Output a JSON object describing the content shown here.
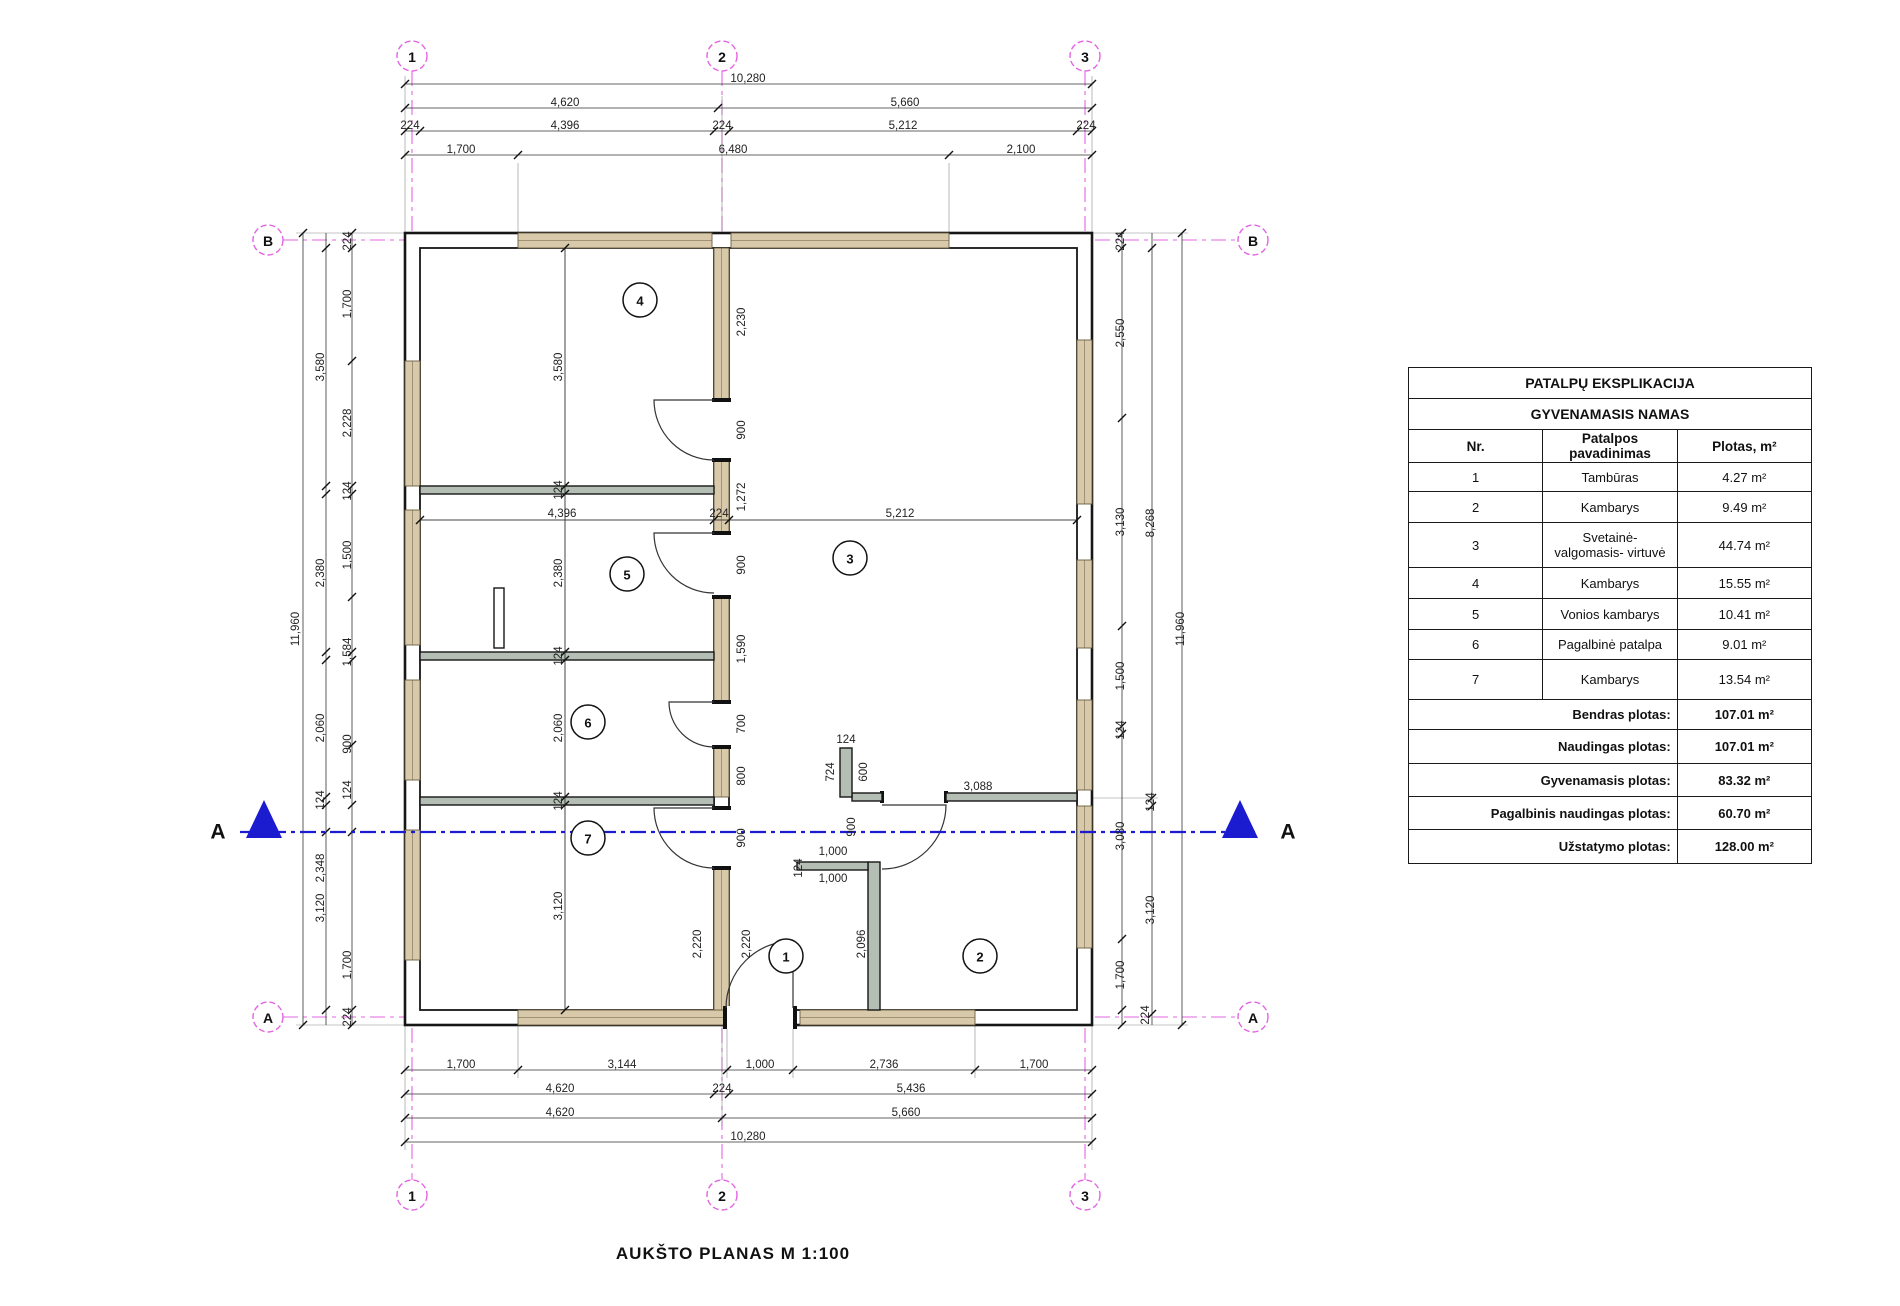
{
  "title": "AUKŠTO PLANAS  M 1:100",
  "colors": {
    "wall_window_fill": "#d8c9aa",
    "window_edge": "#6b5d40",
    "partition_fill": "#b5beb5",
    "grid_line": "#e364e3",
    "section_line": "#1b1bd0",
    "wall_line": "#161616",
    "dim_text": "#222222"
  },
  "section": {
    "label": "A"
  },
  "grid_circles": [
    {
      "label": "1",
      "x": 412,
      "y": 56
    },
    {
      "label": "2",
      "x": 722,
      "y": 56
    },
    {
      "label": "3",
      "x": 1085,
      "y": 56
    },
    {
      "label": "1",
      "x": 412,
      "y": 1195
    },
    {
      "label": "2",
      "x": 722,
      "y": 1195
    },
    {
      "label": "3",
      "x": 1085,
      "y": 1195
    },
    {
      "label": "B",
      "x": 268,
      "y": 240
    },
    {
      "label": "B",
      "x": 1253,
      "y": 240
    },
    {
      "label": "A",
      "x": 268,
      "y": 1017
    },
    {
      "label": "A",
      "x": 1253,
      "y": 1017
    }
  ],
  "room_circles": [
    {
      "label": "1",
      "x": 786,
      "y": 956
    },
    {
      "label": "2",
      "x": 980,
      "y": 956
    },
    {
      "label": "3",
      "x": 850,
      "y": 558
    },
    {
      "label": "4",
      "x": 640,
      "y": 300
    },
    {
      "label": "5",
      "x": 627,
      "y": 574
    },
    {
      "label": "6",
      "x": 588,
      "y": 722
    },
    {
      "label": "7",
      "x": 588,
      "y": 838
    }
  ],
  "dim_labels": [
    {
      "t": "10,280",
      "x": 748,
      "y": 79,
      "r": 0
    },
    {
      "t": "4,620",
      "x": 565,
      "y": 103,
      "r": 0
    },
    {
      "t": "5,660",
      "x": 905,
      "y": 103,
      "r": 0
    },
    {
      "t": "224",
      "x": 410,
      "y": 126,
      "r": 0
    },
    {
      "t": "4,396",
      "x": 565,
      "y": 126,
      "r": 0
    },
    {
      "t": "224",
      "x": 722,
      "y": 126,
      "r": 0
    },
    {
      "t": "5,212",
      "x": 903,
      "y": 126,
      "r": 0
    },
    {
      "t": "224",
      "x": 1086,
      "y": 126,
      "r": 0
    },
    {
      "t": "1,700",
      "x": 461,
      "y": 150,
      "r": 0
    },
    {
      "t": "6,480",
      "x": 733,
      "y": 150,
      "r": 0
    },
    {
      "t": "2,100",
      "x": 1021,
      "y": 150,
      "r": 0
    },
    {
      "t": "1,700",
      "x": 461,
      "y": 1065,
      "r": 0
    },
    {
      "t": "3,144",
      "x": 622,
      "y": 1065,
      "r": 0
    },
    {
      "t": "1,000",
      "x": 760,
      "y": 1065,
      "r": 0
    },
    {
      "t": "2,736",
      "x": 884,
      "y": 1065,
      "r": 0
    },
    {
      "t": "1,700",
      "x": 1034,
      "y": 1065,
      "r": 0
    },
    {
      "t": "4,620",
      "x": 560,
      "y": 1089,
      "r": 0
    },
    {
      "t": "224",
      "x": 722,
      "y": 1089,
      "r": 0
    },
    {
      "t": "5,436",
      "x": 911,
      "y": 1089,
      "r": 0
    },
    {
      "t": "4,620",
      "x": 560,
      "y": 1113,
      "r": 0
    },
    {
      "t": "5,660",
      "x": 906,
      "y": 1113,
      "r": 0
    },
    {
      "t": "10,280",
      "x": 748,
      "y": 1137,
      "r": 0
    },
    {
      "t": "11,960",
      "x": 296,
      "y": 629,
      "r": 1
    },
    {
      "t": "3,580",
      "x": 321,
      "y": 367,
      "r": 1
    },
    {
      "t": "2,380",
      "x": 321,
      "y": 573,
      "r": 1
    },
    {
      "t": "2,060",
      "x": 321,
      "y": 728,
      "r": 1
    },
    {
      "t": "124",
      "x": 321,
      "y": 800,
      "r": 1
    },
    {
      "t": "2,348",
      "x": 321,
      "y": 868,
      "r": 1
    },
    {
      "t": "3,120",
      "x": 321,
      "y": 908,
      "r": 1
    },
    {
      "t": "224",
      "x": 348,
      "y": 241,
      "r": 1
    },
    {
      "t": "1,700",
      "x": 348,
      "y": 304,
      "r": 1
    },
    {
      "t": "2,228",
      "x": 348,
      "y": 423,
      "r": 1
    },
    {
      "t": "124",
      "x": 348,
      "y": 491,
      "r": 1
    },
    {
      "t": "1,500",
      "x": 348,
      "y": 555,
      "r": 1
    },
    {
      "t": "1,584",
      "x": 348,
      "y": 652,
      "r": 1
    },
    {
      "t": "900",
      "x": 348,
      "y": 744,
      "r": 1
    },
    {
      "t": "124",
      "x": 348,
      "y": 790,
      "r": 1
    },
    {
      "t": "1,700",
      "x": 348,
      "y": 965,
      "r": 1
    },
    {
      "t": "224",
      "x": 348,
      "y": 1017,
      "r": 1
    },
    {
      "t": "224",
      "x": 1121,
      "y": 241,
      "r": 1
    },
    {
      "t": "2,550",
      "x": 1121,
      "y": 333,
      "r": 1
    },
    {
      "t": "3,130",
      "x": 1121,
      "y": 522,
      "r": 1
    },
    {
      "t": "1,500",
      "x": 1121,
      "y": 676,
      "r": 1
    },
    {
      "t": "124",
      "x": 1121,
      "y": 730,
      "r": 1
    },
    {
      "t": "3,080",
      "x": 1121,
      "y": 836,
      "r": 1
    },
    {
      "t": "1,700",
      "x": 1121,
      "y": 975,
      "r": 1
    },
    {
      "t": "224",
      "x": 1146,
      "y": 1015,
      "r": 1
    },
    {
      "t": "8,268",
      "x": 1151,
      "y": 523,
      "r": 1
    },
    {
      "t": "124",
      "x": 1151,
      "y": 802,
      "r": 1
    },
    {
      "t": "3,120",
      "x": 1151,
      "y": 910,
      "r": 1
    },
    {
      "t": "11,960",
      "x": 1181,
      "y": 629,
      "r": 1
    },
    {
      "t": "3,580",
      "x": 559,
      "y": 367,
      "r": 1
    },
    {
      "t": "124",
      "x": 559,
      "y": 490,
      "r": 1
    },
    {
      "t": "2,380",
      "x": 559,
      "y": 573,
      "r": 1
    },
    {
      "t": "124",
      "x": 559,
      "y": 656,
      "r": 1
    },
    {
      "t": "2,060",
      "x": 559,
      "y": 728,
      "r": 1
    },
    {
      "t": "124",
      "x": 559,
      "y": 801,
      "r": 1
    },
    {
      "t": "3,120",
      "x": 559,
      "y": 906,
      "r": 1
    },
    {
      "t": "4,396",
      "x": 562,
      "y": 514,
      "r": 0
    },
    {
      "t": "224",
      "x": 719,
      "y": 514,
      "r": 0
    },
    {
      "t": "5,212",
      "x": 900,
      "y": 514,
      "r": 0
    },
    {
      "t": "2,230",
      "x": 742,
      "y": 322,
      "r": 1
    },
    {
      "t": "900",
      "x": 742,
      "y": 430,
      "r": 1
    },
    {
      "t": "1,272",
      "x": 742,
      "y": 497,
      "r": 1
    },
    {
      "t": "900",
      "x": 742,
      "y": 565,
      "r": 1
    },
    {
      "t": "1,590",
      "x": 742,
      "y": 649,
      "r": 1
    },
    {
      "t": "700",
      "x": 742,
      "y": 724,
      "r": 1
    },
    {
      "t": "800",
      "x": 742,
      "y": 776,
      "r": 1
    },
    {
      "t": "900",
      "x": 742,
      "y": 838,
      "r": 1
    },
    {
      "t": "2,220",
      "x": 747,
      "y": 944,
      "r": 1
    },
    {
      "t": "124",
      "x": 846,
      "y": 740,
      "r": 0
    },
    {
      "t": "724",
      "x": 831,
      "y": 772,
      "r": 1
    },
    {
      "t": "600",
      "x": 864,
      "y": 772,
      "r": 1
    },
    {
      "t": "3,088",
      "x": 978,
      "y": 787,
      "r": 0
    },
    {
      "t": "1,000",
      "x": 833,
      "y": 852,
      "r": 0
    },
    {
      "t": "1,000",
      "x": 833,
      "y": 879,
      "r": 0
    },
    {
      "t": "124",
      "x": 799,
      "y": 868,
      "r": 1
    },
    {
      "t": "900",
      "x": 852,
      "y": 827,
      "r": 1
    },
    {
      "t": "2,096",
      "x": 862,
      "y": 944,
      "r": 1
    },
    {
      "t": "2,220",
      "x": 698,
      "y": 944,
      "r": 1
    }
  ],
  "table": {
    "title1": "PATALPŲ EKSPLIKACIJA",
    "title2": "GYVENAMASIS NAMAS",
    "headers": {
      "nr": "Nr.",
      "name": "Patalpos pavadinimas",
      "area": "Plotas, m²"
    },
    "rows": [
      {
        "nr": "1",
        "name": "Tambūras",
        "area": "4.27 m²"
      },
      {
        "nr": "2",
        "name": "Kambarys",
        "area": "9.49 m²"
      },
      {
        "nr": "3",
        "name": "Svetainė- valgomasis- virtuvė",
        "area": "44.74 m²"
      },
      {
        "nr": "4",
        "name": "Kambarys",
        "area": "15.55 m²"
      },
      {
        "nr": "5",
        "name": "Vonios kambarys",
        "area": "10.41 m²"
      },
      {
        "nr": "6",
        "name": "Pagalbinė patalpa",
        "area": "9.01 m²"
      },
      {
        "nr": "7",
        "name": "Kambarys",
        "area": "13.54 m²"
      }
    ],
    "totals": [
      {
        "label": "Bendras plotas:",
        "value": "107.01 m²"
      },
      {
        "label": "Naudingas plotas:",
        "value": "107.01 m²"
      },
      {
        "label": "Gyvenamasis plotas:",
        "value": "83.32 m²"
      },
      {
        "label": "Pagalbinis naudingas plotas:",
        "value": "60.70 m²"
      },
      {
        "label": "Užstatymo plotas:",
        "value": "128.00 m²"
      }
    ]
  }
}
